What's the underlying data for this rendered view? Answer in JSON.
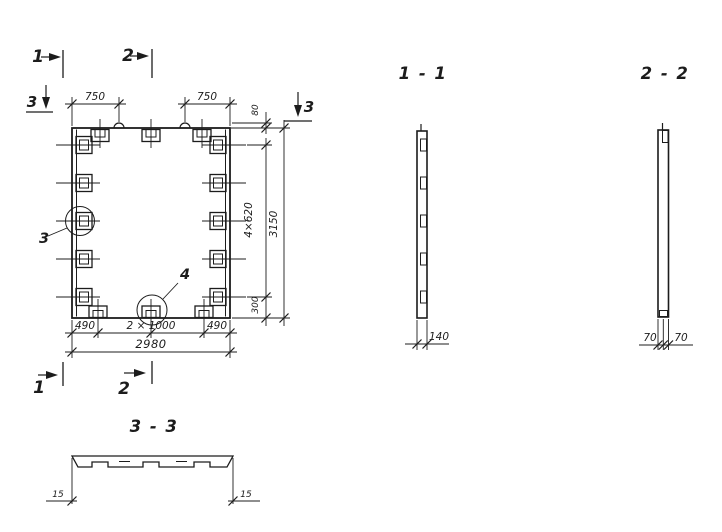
{
  "colors": {
    "ink": "#1c1c1c",
    "paper": "#ffffff"
  },
  "plan": {
    "section_marks": {
      "one": "1",
      "two": "2",
      "three": "3"
    },
    "callouts": {
      "three": "3",
      "four": "4"
    },
    "dims": {
      "top_left": "750",
      "top_right": "750",
      "top_lip": "80",
      "side_pitch": "4×620",
      "side_end": "300",
      "height_total": "3150",
      "bottom_left": "490",
      "bottom_middle": "2 × 1000",
      "bottom_right": "490",
      "width_total": "2980"
    }
  },
  "sections": {
    "s11": {
      "title": "1 - 1",
      "thickness": "140"
    },
    "s22": {
      "title": "2 - 2",
      "left": "70",
      "right": "70"
    },
    "s33": {
      "title": "3 - 3",
      "left": "15",
      "right": "15"
    }
  }
}
